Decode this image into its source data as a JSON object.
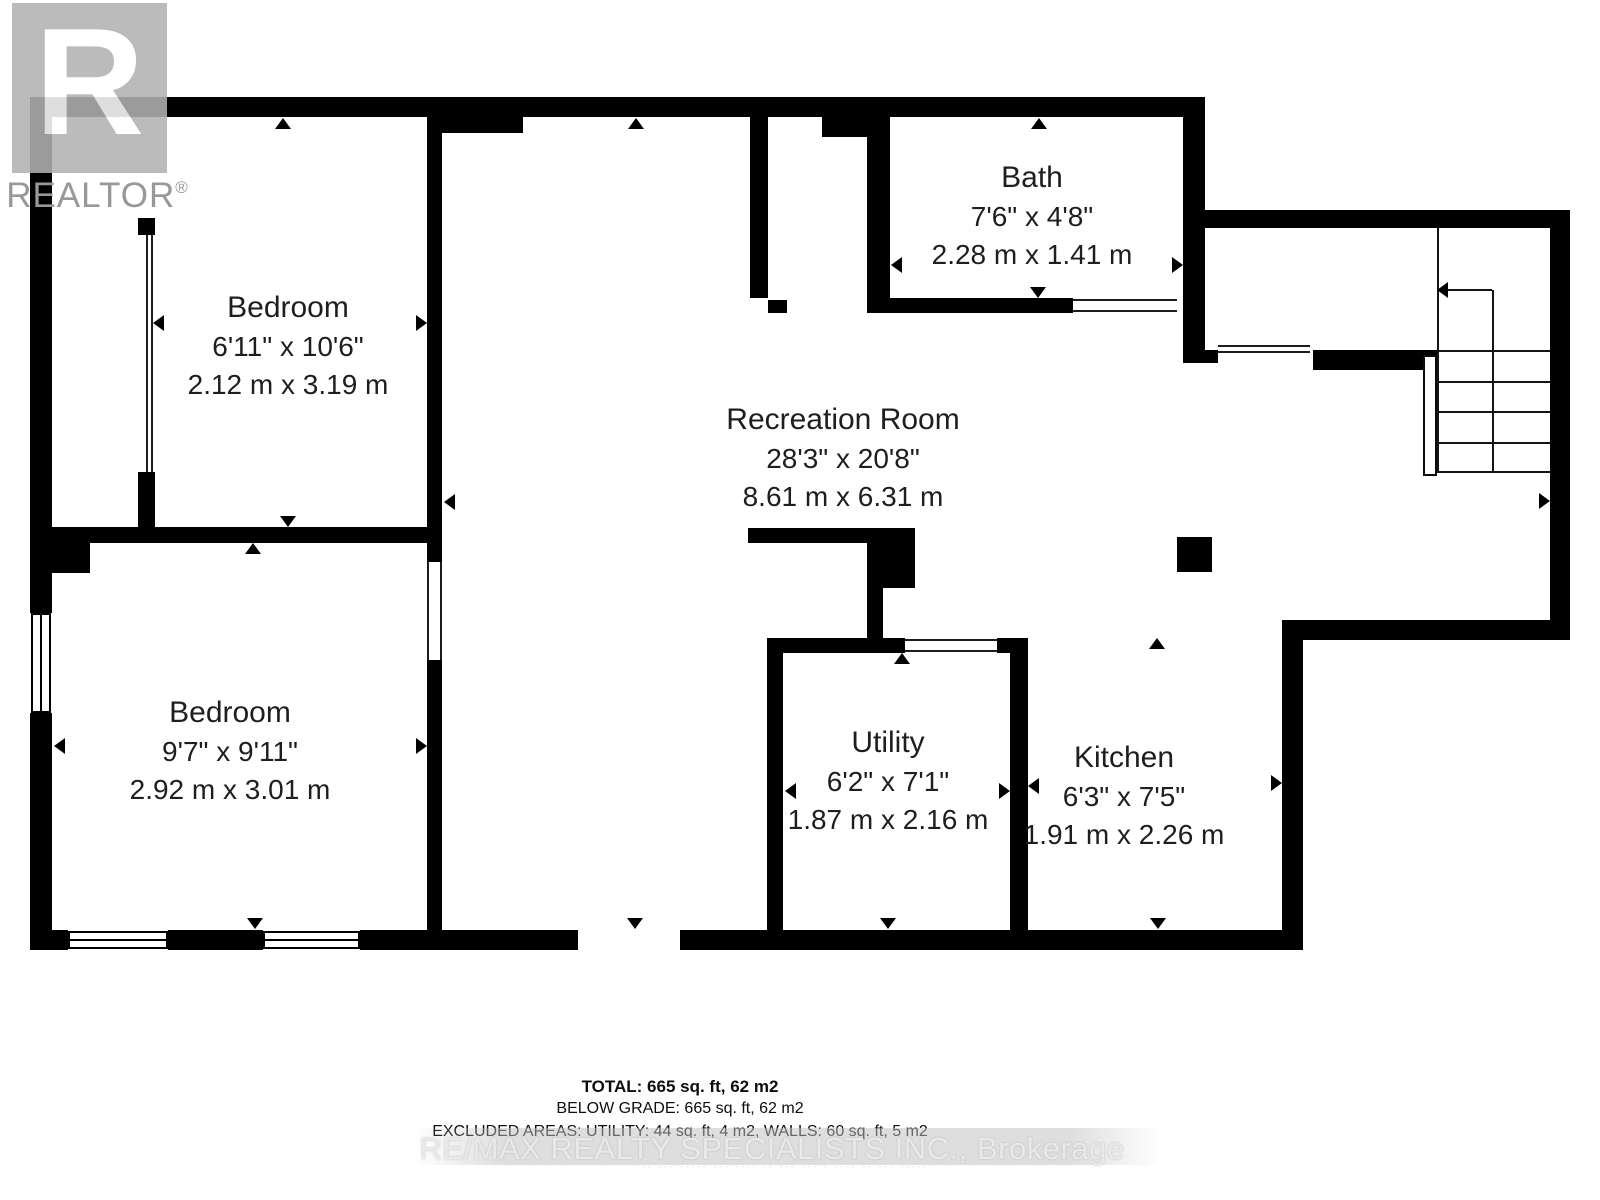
{
  "logo": {
    "r_letter": "R",
    "wordmark": "REALTOR",
    "registered": "®"
  },
  "footer": {
    "total": "TOTAL: 665 sq. ft, 62 m2",
    "below_grade": "BELOW GRADE: 665 sq. ft, 62 m2",
    "excluded": "EXCLUDED AREAS: UTILITY: 44 sq. ft, 4 m2, WALLS: 60 sq. ft, 5 m2",
    "watermark": "RE/MAX REALTY SPECIALISTS INC., Brokerage",
    "fine_print": "·· ··· ····· ··· ···· ·· ··· ··· · ···· ·· ··· ·····"
  },
  "plan": {
    "wall_color": "#000000",
    "rooms": [
      {
        "name": "Bedroom",
        "imperial": "6'11\" x 10'6\"",
        "metric": "2.12 m x 3.19 m",
        "cx": 288,
        "top": 288
      },
      {
        "name": "Bath",
        "imperial": "7'6\" x 4'8\"",
        "metric": "2.28 m x 1.41 m",
        "cx": 1032,
        "top": 158
      },
      {
        "name": "Recreation Room",
        "imperial": "28'3\" x 20'8\"",
        "metric": "8.61 m x 6.31 m",
        "cx": 843,
        "top": 400
      },
      {
        "name": "Bedroom",
        "imperial": "9'7\" x 9'11\"",
        "metric": "2.92 m x 3.01 m",
        "cx": 230,
        "top": 693
      },
      {
        "name": "Utility",
        "imperial": "6'2\" x 7'1\"",
        "metric": "1.87 m x 2.16 m",
        "cx": 888,
        "top": 723
      },
      {
        "name": "Kitchen",
        "imperial": "6'3\" x 7'5\"",
        "metric": "1.91 m x 2.26 m",
        "cx": 1124,
        "top": 738
      }
    ],
    "walls": [
      [
        30,
        97,
        1175,
        20
      ],
      [
        427,
        115,
        96,
        18
      ],
      [
        30,
        97,
        22,
        516
      ],
      [
        30,
        713,
        22,
        237
      ],
      [
        30,
        543,
        60,
        30
      ],
      [
        30,
        930,
        38,
        20
      ],
      [
        168,
        930,
        95,
        20
      ],
      [
        360,
        930,
        218,
        20
      ],
      [
        680,
        930,
        623,
        20
      ],
      [
        1183,
        97,
        22,
        266
      ],
      [
        1205,
        210,
        365,
        18
      ],
      [
        1550,
        210,
        20,
        430
      ],
      [
        1282,
        620,
        288,
        20
      ],
      [
        1282,
        620,
        21,
        330
      ],
      [
        1313,
        350,
        124,
        20
      ],
      [
        1185,
        350,
        33,
        13
      ],
      [
        427,
        115,
        15,
        428
      ],
      [
        427,
        543,
        15,
        19
      ],
      [
        427,
        660,
        15,
        290
      ],
      [
        52,
        527,
        390,
        16
      ],
      [
        138,
        218,
        17,
        17
      ],
      [
        138,
        472,
        17,
        55
      ],
      [
        750,
        115,
        18,
        183
      ],
      [
        768,
        300,
        19,
        13
      ],
      [
        867,
        115,
        23,
        198
      ],
      [
        822,
        115,
        45,
        22
      ],
      [
        890,
        298,
        183,
        15
      ],
      [
        748,
        528,
        167,
        15
      ],
      [
        867,
        528,
        48,
        60
      ],
      [
        867,
        588,
        16,
        65
      ],
      [
        767,
        638,
        138,
        15
      ],
      [
        997,
        638,
        31,
        15
      ],
      [
        767,
        653,
        16,
        277
      ],
      [
        1010,
        638,
        18,
        292
      ],
      [
        1177,
        537,
        35,
        35
      ]
    ],
    "lines": [
      [
        1437,
        228,
        2,
        245
      ],
      [
        1492,
        290,
        2,
        183
      ],
      [
        1437,
        350,
        113,
        2
      ],
      [
        1437,
        381,
        113,
        2
      ],
      [
        1437,
        411,
        113,
        2
      ],
      [
        1437,
        442,
        113,
        2
      ],
      [
        1437,
        471,
        113,
        2
      ],
      [
        1445,
        289,
        47,
        2
      ]
    ],
    "windows": [
      {
        "x": 31,
        "y": 613,
        "w": 20,
        "h": 100,
        "o": "v"
      },
      {
        "x": 68,
        "y": 931,
        "w": 100,
        "h": 18,
        "o": "h"
      },
      {
        "x": 263,
        "y": 931,
        "w": 97,
        "h": 18,
        "o": "h"
      }
    ],
    "openings": [
      {
        "x": 905,
        "y": 639,
        "w": 92,
        "h": 13,
        "s": "tb"
      },
      {
        "x": 1073,
        "y": 299,
        "w": 104,
        "h": 13,
        "s": "tb"
      },
      {
        "x": 1218,
        "y": 345,
        "w": 92,
        "h": 8,
        "s": "tb"
      },
      {
        "x": 427,
        "y": 562,
        "w": 15,
        "h": 98,
        "s": "lr"
      },
      {
        "x": 146,
        "y": 235,
        "w": 7,
        "h": 237,
        "s": "lr"
      },
      {
        "x": 1423,
        "y": 355,
        "w": 14,
        "h": 121,
        "s": "all"
      }
    ],
    "arrows": [
      [
        283,
        118,
        "up"
      ],
      [
        288,
        527,
        "down"
      ],
      [
        153,
        323,
        "left"
      ],
      [
        427,
        323,
        "right"
      ],
      [
        54,
        746,
        "left"
      ],
      [
        427,
        746,
        "right"
      ],
      [
        253,
        543,
        "up"
      ],
      [
        255,
        929,
        "down"
      ],
      [
        636,
        118,
        "up"
      ],
      [
        635,
        929,
        "down"
      ],
      [
        444,
        502,
        "left"
      ],
      [
        1550,
        501,
        "right"
      ],
      [
        891,
        265,
        "left"
      ],
      [
        1183,
        265,
        "right"
      ],
      [
        1039,
        118,
        "up"
      ],
      [
        1038,
        298,
        "down"
      ],
      [
        785,
        791,
        "left"
      ],
      [
        1010,
        791,
        "right"
      ],
      [
        902,
        653,
        "up"
      ],
      [
        888,
        929,
        "down"
      ],
      [
        1028,
        786,
        "left"
      ],
      [
        1282,
        783,
        "right"
      ],
      [
        1157,
        638,
        "up"
      ],
      [
        1158,
        929,
        "down"
      ],
      [
        1437,
        290,
        "left"
      ]
    ]
  }
}
